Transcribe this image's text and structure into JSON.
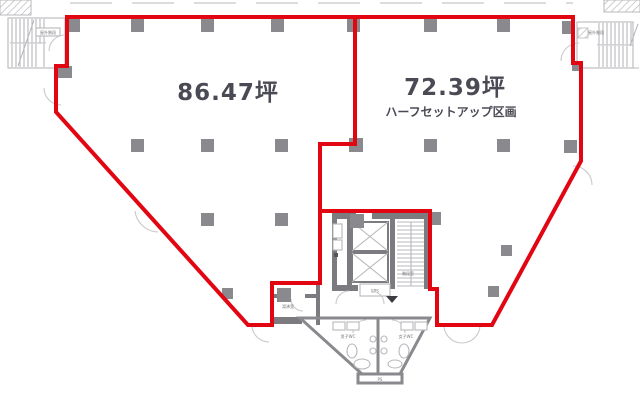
{
  "floorplan": {
    "title": "office floor plan with two leasable sections outlined in red",
    "areas": {
      "left": {
        "label": "86.47坪"
      },
      "right": {
        "label": "72.39坪",
        "sublabel": "ハーフセットアップ区画"
      }
    },
    "tiny_labels": {
      "stair_left": "屋外階段",
      "stair_right": "屋外階段",
      "stair_core": "階段室",
      "eps": "EPS",
      "room_small": "湯沸室",
      "wc_left": "男子WC",
      "wc_right": "女子WC",
      "ps": "PS"
    },
    "colors": {
      "boundary_red": "#e20613",
      "pillar_gray": "#8a8a8e",
      "wall_gray": "#7c7c80",
      "detail_light_gray": "#c9c9cd",
      "label_text": "#4a4a54",
      "background": "#ffffff"
    }
  }
}
